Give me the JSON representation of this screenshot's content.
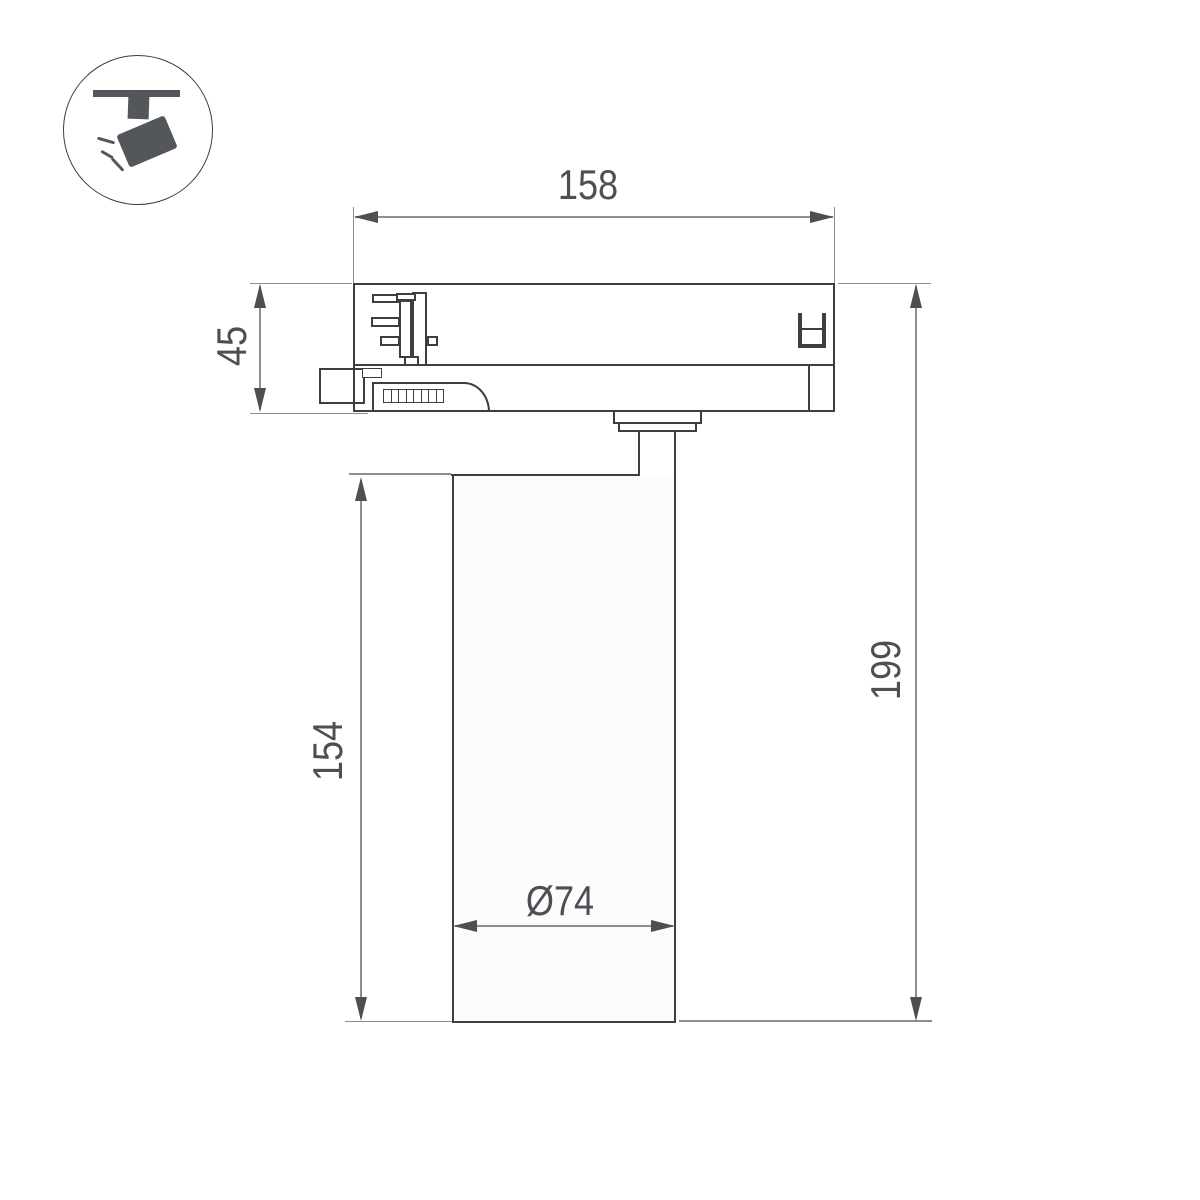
{
  "page": {
    "background": "#ffffff"
  },
  "icon_badge": {
    "name": "track-spotlight-icon"
  },
  "dimension_labels": {
    "adapter_width": "158",
    "adapter_height": "45",
    "body_height": "154",
    "total_height": "199",
    "body_diameter": "Ø74"
  },
  "colors": {
    "outline": "#3b3e42",
    "dimension_line": "#8e8e8e",
    "dimension_text": "#4c4f53",
    "icon_fill": "#53575c"
  }
}
